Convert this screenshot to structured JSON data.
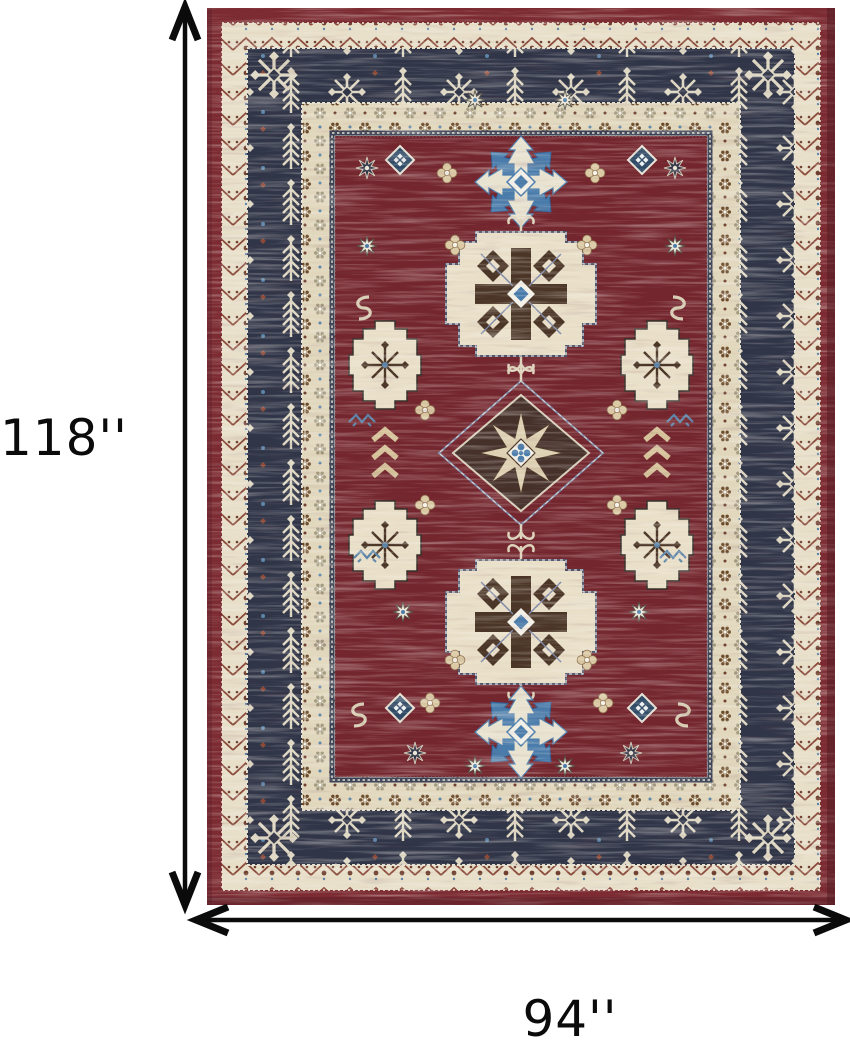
{
  "diagram": {
    "type": "product dimension diagram",
    "height_label": "118''",
    "width_label": "94''",
    "arrow_color": "#0b0b0b",
    "background_color": "#ffffff"
  },
  "rug": {
    "description": "Kazak-style oriental area rug, burgundy field with three geometric medallions, navy ornamental border, cream guard bands, blue snowflake accents",
    "colors": {
      "outer_band_red": "#7c2b32",
      "field_red": "#74262e",
      "border_navy": "#303548",
      "band_cream": "#e8dfc9",
      "band_cream_dots": "#e1d7bd",
      "motif_cream": "#e6dcc4",
      "motif_white": "#f2efe6",
      "accent_blue": "#4a7cab",
      "accent_slate": "#7b87a8",
      "accent_dark_brown": "#4a3526",
      "accent_rust": "#8a4a3a"
    }
  }
}
